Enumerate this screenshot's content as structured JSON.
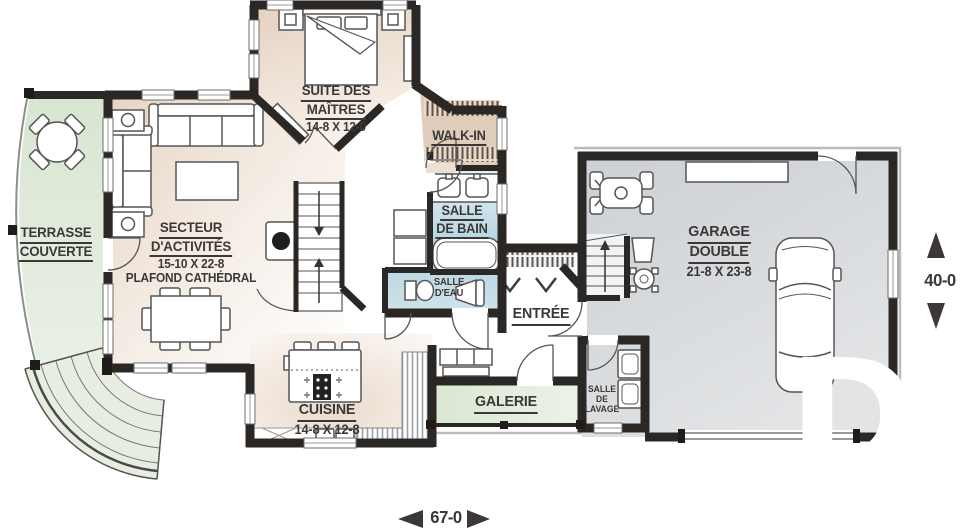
{
  "rooms": {
    "terrace": {
      "name1": "TERRASSE",
      "name2": "COUVERTE"
    },
    "living": {
      "name1": "SECTEUR",
      "name2": "D'ACTIVITÉS",
      "size": "15-10 X 22-8",
      "note": "PLAFOND CATHÉDRAL"
    },
    "master": {
      "name1": "SUITE DES",
      "name2": "MAÎTRES",
      "size": "14-8 X 12-0"
    },
    "walkin": {
      "name": "WALK-IN"
    },
    "bath": {
      "name1": "SALLE",
      "name2": "DE BAIN"
    },
    "powder": {
      "name1": "SALLE",
      "name2": "D'EAU"
    },
    "entry": {
      "name": "ENTRÉE"
    },
    "kitchen": {
      "name": "CUISINE",
      "size": "14-8 X 12-8"
    },
    "gallery": {
      "name": "GALERIE"
    },
    "laundry": {
      "name1": "SALLE",
      "name2": "DE",
      "name3": "LAVAGE"
    },
    "garage": {
      "name1": "GARAGE",
      "name2": "DOUBLE",
      "size": "21-8 X 23-8"
    }
  },
  "dimensions": {
    "width": "67-0",
    "depth": "40-0"
  },
  "watermark": {
    "letter": "D"
  },
  "colors": {
    "wall": "#2b2724",
    "beige": "#e7d6c5",
    "green": "#dde9d6",
    "blue": "#a8cddb",
    "garage_gray": "#d2d5d8",
    "text": "#3b3837"
  }
}
